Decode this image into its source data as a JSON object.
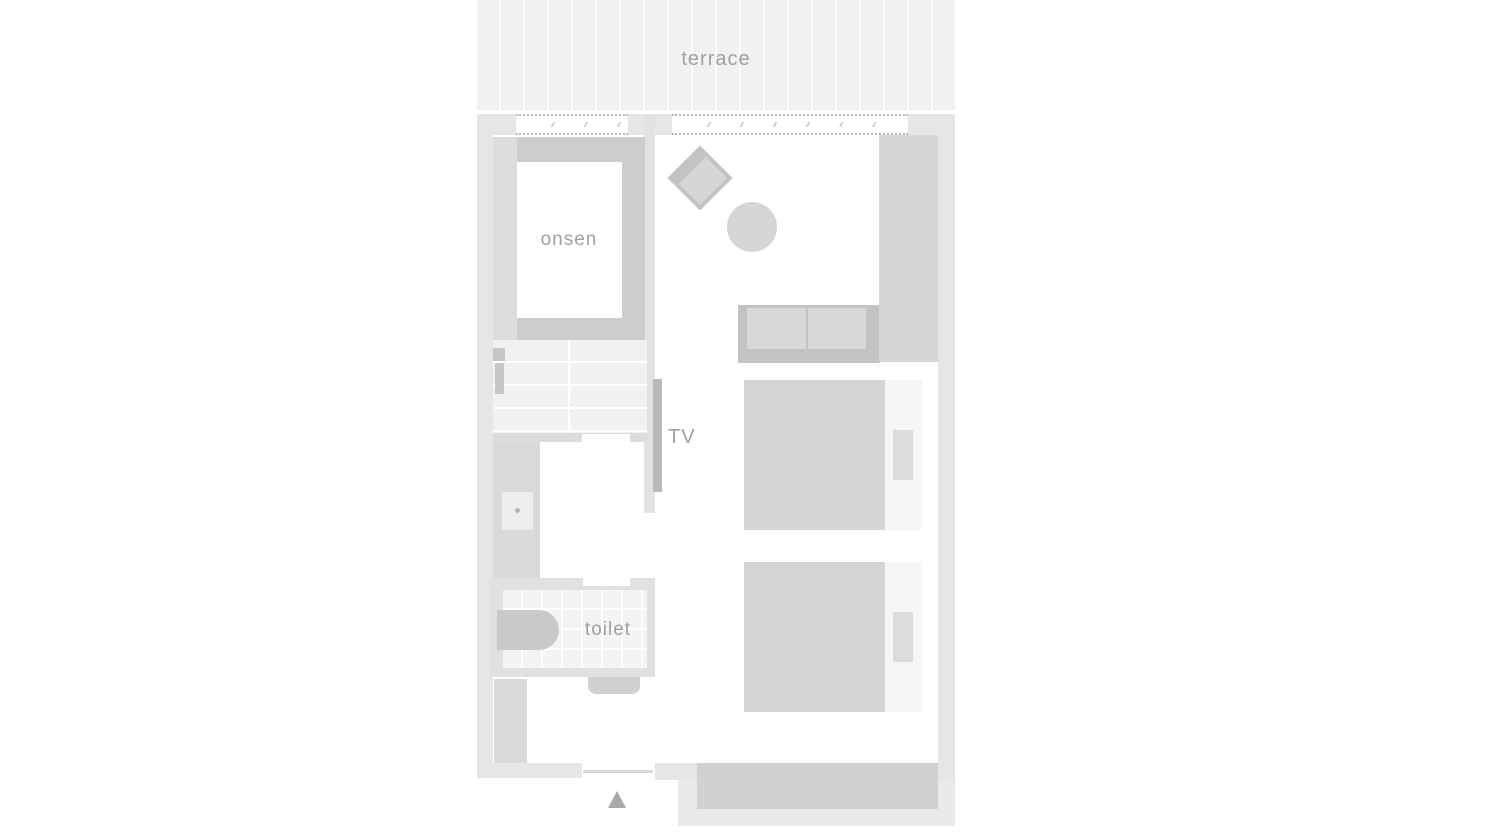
{
  "rooms": {
    "terrace": {
      "label": "terrace"
    },
    "onsen": {
      "label": "onsen"
    },
    "tv": {
      "label": "TV"
    },
    "toilet": {
      "label": "toilet"
    }
  },
  "colors": {
    "canvas": "#ffffff",
    "terrace": "#f1f1f1",
    "wall": "#e6e6e6",
    "wall-inner": "#e2e2e2",
    "wall-toilet": "#e1e1e1",
    "dots": "#b8b8b8",
    "ledge": "#dcdcdc",
    "rim": "#cdcdcd",
    "tile": "#f1f1f1",
    "tile-toilet": "#f4f4f4",
    "fixture": "#c6c6c6",
    "cabinet": "#d9d9d9",
    "sink": "#ededed",
    "bowl": "#c9c9c9",
    "furn": "#d6d6d6",
    "furn-dark": "#c3c3c3",
    "cushion": "#d8d8d8",
    "bed": "#d5d5d5",
    "sheet": "#f6f6f6",
    "pillow": "#dcdcdc",
    "tv": "#b9b9b9",
    "genkan": "#d1d1d1",
    "entry-block": "#eaeaea",
    "arrow": "#a9a9a9",
    "label": "#a0a0a0"
  }
}
